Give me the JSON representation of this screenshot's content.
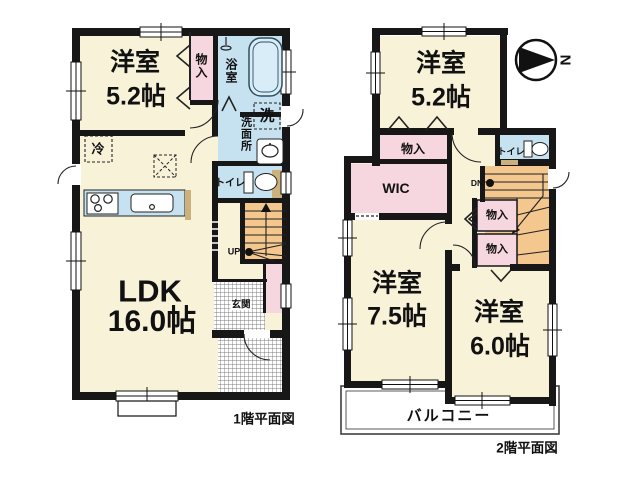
{
  "palette": {
    "room_cream": "#F8F2D9",
    "closet_pink": "#F6D6DF",
    "wet_area_blue": "#C6E2F1",
    "stairs_orange": "#F3C78E",
    "door_tan": "#CDB17C",
    "wall_black": "#171717",
    "background": "#FFFFFF"
  },
  "compass": {
    "north_label": "N"
  },
  "floor1": {
    "caption": "1階平面図",
    "rooms": {
      "western": {
        "name": "洋室",
        "size": "5.2帖"
      },
      "ldk": {
        "name": "LDK",
        "size": "16.0帖"
      },
      "closet": {
        "label": "物入"
      },
      "bath": {
        "label": "浴室"
      },
      "washroom": {
        "label": "洗面所"
      },
      "washer": {
        "label": "洗"
      },
      "toilet": {
        "label": "トイレ"
      },
      "fridge": {
        "label": "冷"
      },
      "entrance": {
        "label": "玄関"
      },
      "stairs": {
        "label": "UP"
      }
    }
  },
  "floor2": {
    "caption": "2階平面図",
    "rooms": {
      "western_small": {
        "name": "洋室",
        "size": "5.2帖"
      },
      "western_medium": {
        "name": "洋室",
        "size": "7.5帖"
      },
      "western_large": {
        "name": "洋室",
        "size": "6.0帖"
      },
      "closet_upper": {
        "label": "物入"
      },
      "wic": {
        "label": "WIC"
      },
      "toilet": {
        "label": "トイレ"
      },
      "closet_a": {
        "label": "物入"
      },
      "closet_b": {
        "label": "物入"
      },
      "stairs": {
        "label": "DN"
      },
      "balcony": {
        "label": "バルコニー"
      }
    }
  },
  "icons": {
    "north-arrow-icon": "black triangle in circle pointing right",
    "bathtub-icon": "rounded rectangle tub",
    "shower-icon": "shower head",
    "washbasin-icon": "oval basin",
    "toilet-icon": "tank and bowl",
    "stove-icon": "three burner circles",
    "kitchen-sink-icon": "rounded sink",
    "stairs-up-icon": "UP arrow with dot",
    "stairs-down-icon": "DN arrow with dot"
  }
}
